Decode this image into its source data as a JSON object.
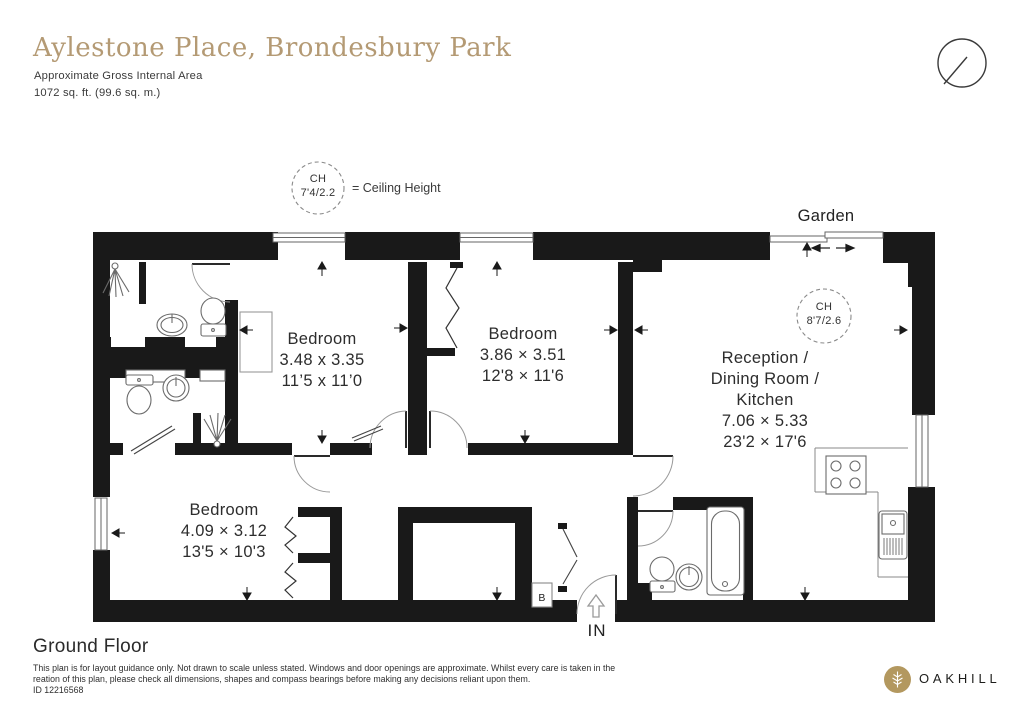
{
  "header": {
    "title": "Aylestone Place, Brondesbury Park",
    "area_label": "Approximate Gross Internal Area",
    "area_value": "1072 sq. ft. (99.6 sq. m.)"
  },
  "legend": {
    "ch_abbr": "CH",
    "ch_value": "7'4/2.2",
    "ch_meaning": "= Ceiling Height"
  },
  "plan": {
    "garden_label": "Garden",
    "entrance_label": "IN",
    "boiler_label": "B",
    "reception_ch": {
      "ch_abbr": "CH",
      "ch_value": "8'7/2.6"
    },
    "rooms": {
      "bedroom1": {
        "name": "Bedroom",
        "metric": "3.48 x 3.35",
        "imperial": "11’5 x 11’0"
      },
      "bedroom2": {
        "name": "Bedroom",
        "metric": "3.86 × 3.51",
        "imperial": "12'8 × 11'6"
      },
      "reception": {
        "name_line1": "Reception /",
        "name_line2": "Dining Room /",
        "name_line3": "Kitchen",
        "metric": "7.06 × 5.33",
        "imperial": "23'2 × 17'6"
      },
      "bedroom3": {
        "name": "Bedroom",
        "metric": "4.09 × 3.12",
        "imperial": "13'5 × 10'3"
      }
    }
  },
  "footer": {
    "floor_label": "Ground Floor",
    "disclaimer_line1": "This plan is for layout guidance only. Not drawn to scale unless stated. Windows and door openings are approximate. Whilst every care is taken in the",
    "disclaimer_line2": "reation of this plan, please check all dimensions, shapes and compass bearings before making any decisions reliant upon them.",
    "plan_id": "ID 12216568",
    "brand_name": "OAKHILL"
  },
  "colors": {
    "accent_gold": "#b49a74",
    "logo_gold": "#b3985f",
    "wall_black": "#191919",
    "text_dark": "#2d2d2d"
  }
}
